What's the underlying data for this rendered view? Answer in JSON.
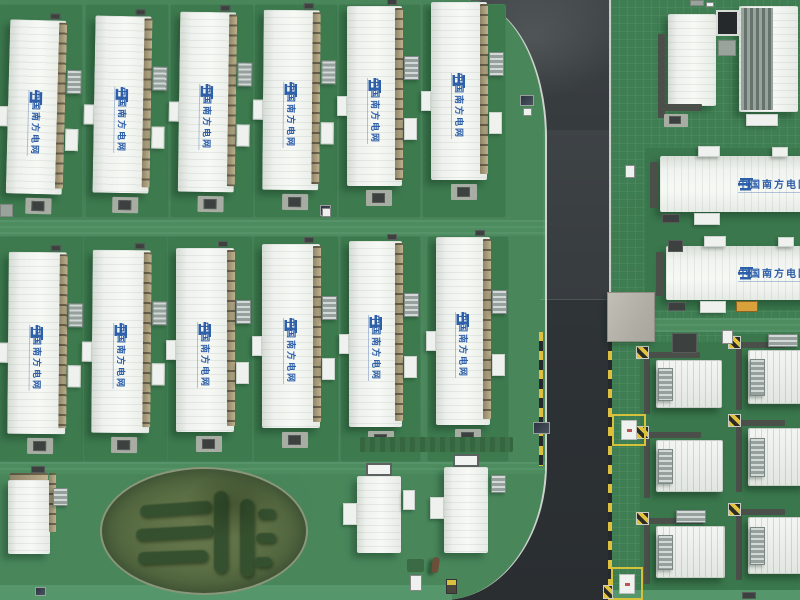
{
  "meta": {
    "title": "Aerial view of a China Southern Power Grid battery energy storage station",
    "view": "top-down drone photo",
    "width": 800,
    "height": 600
  },
  "branding": {
    "label": "中国南方电网",
    "logo": "csg-grid-logo",
    "brand_color": "#2e5fa9"
  },
  "palette": {
    "grass_base": "#49875b",
    "grass_pad": "#3d7a4e",
    "grass_right": "#3f7e52",
    "path_light": "#4c8c5f",
    "bottom_strip": "#55966b",
    "road_surface": "#303437",
    "curb_white": "#cdd2cc",
    "hazard_yellow": "#dec03e",
    "hazard_dark": "#26292c",
    "building_white": "#f3f5f2",
    "walkway_tan": "#b3a484",
    "oval_inner": "#5d7045",
    "hedge_dark": "#35502f",
    "concrete": "#b4b1a8"
  },
  "scene": {
    "road": {
      "x": 420,
      "w": 205,
      "curb_left_x": 545,
      "curb_right_x": 607,
      "dashes": [
        {
          "x": 539,
          "y": 332,
          "h": 134
        },
        {
          "x": 608,
          "y": 332,
          "h": 268
        }
      ]
    },
    "bands": [
      {
        "x": 0,
        "y": 220,
        "w": 545,
        "h": 16,
        "dir": "h"
      },
      {
        "x": 0,
        "y": 462,
        "w": 545,
        "h": 12,
        "dir": "h"
      },
      {
        "x": 609,
        "y": 318,
        "w": 191,
        "h": 14,
        "dir": "h"
      }
    ],
    "bottom_strips": [
      {
        "x": 0,
        "y": 585,
        "w": 452,
        "h": 15
      },
      {
        "x": 609,
        "y": 590,
        "w": 191,
        "h": 10
      }
    ],
    "pad_rows": [
      {
        "top": 4,
        "h": 214,
        "row": 1
      },
      {
        "top": 236,
        "h": 226,
        "row": 2
      }
    ],
    "pads_right": [
      {
        "x": 640,
        "y": 342,
        "w": 96,
        "h": 248
      },
      {
        "x": 736,
        "y": 334,
        "w": 64,
        "h": 256
      },
      {
        "x": 645,
        "y": 148,
        "w": 155,
        "h": 162
      }
    ],
    "vertical_buildings": [
      {
        "x": 8,
        "y": 20,
        "w": 56,
        "h": 174,
        "r": 1.5,
        "row": 1
      },
      {
        "x": 94,
        "y": 16,
        "w": 56,
        "h": 177,
        "r": 1.0,
        "row": 1
      },
      {
        "x": 179,
        "y": 12,
        "w": 56,
        "h": 180,
        "r": 0.8,
        "row": 1
      },
      {
        "x": 263,
        "y": 10,
        "w": 56,
        "h": 180,
        "r": 0.5,
        "row": 1
      },
      {
        "x": 347,
        "y": 6,
        "w": 55,
        "h": 180,
        "r": 0,
        "row": 1
      },
      {
        "x": 431,
        "y": 2,
        "w": 56,
        "h": 178,
        "r": 0,
        "row": 1
      },
      {
        "x": 8,
        "y": 252,
        "w": 58,
        "h": 182,
        "r": 0.5,
        "row": 2
      },
      {
        "x": 92,
        "y": 250,
        "w": 58,
        "h": 183,
        "r": 0.5,
        "row": 2
      },
      {
        "x": 176,
        "y": 248,
        "w": 58,
        "h": 184,
        "r": 0,
        "row": 2
      },
      {
        "x": 262,
        "y": 244,
        "w": 58,
        "h": 184,
        "r": 0,
        "row": 2
      },
      {
        "x": 349,
        "y": 241,
        "w": 53,
        "h": 186,
        "r": 0,
        "row": 2
      },
      {
        "x": 436,
        "y": 237,
        "w": 54,
        "h": 188,
        "r": 0,
        "row": 2
      }
    ],
    "horizontal_buildings": [
      {
        "x": 660,
        "y": 156,
        "w": 150,
        "h": 56,
        "brandLeft": 78,
        "orangeBox": false
      },
      {
        "x": 666,
        "y": 246,
        "w": 144,
        "h": 54,
        "brandLeft": 72,
        "orangeBox": true
      }
    ],
    "small_buildings": [
      {
        "x": 8,
        "y": 480,
        "w": 42,
        "h": 74,
        "vent": false,
        "acRight": true,
        "walkTop": true,
        "sideL": false,
        "sideR": false
      },
      {
        "x": 357,
        "y": 476,
        "w": 44,
        "h": 77,
        "vent": true,
        "acRight": false,
        "walkTop": false,
        "sideL": true,
        "sideR": true
      },
      {
        "x": 444,
        "y": 467,
        "w": 44,
        "h": 86,
        "vent": true,
        "acRight": true,
        "walkTop": false,
        "sideL": true,
        "sideR": false
      }
    ],
    "top_right": {
      "plain": {
        "x": 668,
        "y": 14,
        "w": 48,
        "h": 92
      },
      "ribbed": {
        "x": 739,
        "y": 6,
        "w": 59,
        "h": 106
      },
      "camera": {
        "x": 716,
        "y": 10,
        "w": 23,
        "h": 26
      },
      "camera_base": {
        "x": 718,
        "y": 40,
        "w": 18,
        "h": 16
      },
      "steps": {
        "x": 746,
        "y": 114,
        "w": 32,
        "h": 12
      }
    },
    "containers": [
      {
        "x": 656,
        "y": 360,
        "w": 66,
        "h": 48,
        "topUnit": false
      },
      {
        "x": 748,
        "y": 350,
        "w": 58,
        "h": 54,
        "topUnit": true
      },
      {
        "x": 656,
        "y": 440,
        "w": 67,
        "h": 52,
        "topUnit": false
      },
      {
        "x": 748,
        "y": 428,
        "w": 58,
        "h": 58,
        "topUnit": false
      },
      {
        "x": 656,
        "y": 526,
        "w": 69,
        "h": 52,
        "topUnit": true
      },
      {
        "x": 748,
        "y": 517,
        "w": 58,
        "h": 57,
        "topUnit": false
      }
    ],
    "yellow_boxes": [
      {
        "x": 612,
        "y": 414,
        "w": 34,
        "h": 32
      },
      {
        "x": 611,
        "y": 567,
        "w": 32,
        "h": 33
      }
    ],
    "concrete_pad": {
      "x": 607,
      "y": 292,
      "w": 48,
      "h": 50
    },
    "dark_box": {
      "x": 672,
      "y": 333,
      "w": 25,
      "h": 20
    },
    "white_lid": {
      "x": 722,
      "y": 330,
      "w": 11,
      "h": 14
    },
    "oval": {
      "x": 100,
      "y": 467,
      "w": 208,
      "h": 128,
      "hedges": [
        {
          "x": 38,
          "y": 34,
          "w": 72,
          "h": 12,
          "r": -4
        },
        {
          "x": 34,
          "y": 58,
          "w": 78,
          "h": 12,
          "r": -3
        },
        {
          "x": 36,
          "y": 82,
          "w": 70,
          "h": 12,
          "r": -2
        },
        {
          "x": 112,
          "y": 22,
          "w": 14,
          "h": 82,
          "r": 0
        },
        {
          "x": 138,
          "y": 30,
          "w": 14,
          "h": 78,
          "r": 0
        },
        {
          "x": 156,
          "y": 40,
          "w": 18,
          "h": 10,
          "r": 0
        },
        {
          "x": 154,
          "y": 64,
          "w": 20,
          "h": 10,
          "r": 0
        },
        {
          "x": 152,
          "y": 88,
          "w": 18,
          "h": 10,
          "r": 0
        }
      ]
    },
    "props": [
      {
        "type": "panel",
        "x": 520,
        "y": 95,
        "w": 14,
        "h": 11
      },
      {
        "type": "whitebox",
        "x": 523,
        "y": 108,
        "w": 9,
        "h": 8
      },
      {
        "type": "panel",
        "x": 533,
        "y": 422,
        "w": 17,
        "h": 12
      },
      {
        "type": "panel",
        "x": 320,
        "y": 205,
        "w": 11,
        "h": 11
      },
      {
        "type": "panel",
        "x": 35,
        "y": 587,
        "w": 11,
        "h": 9
      },
      {
        "type": "whitebox",
        "x": 625,
        "y": 165,
        "w": 10,
        "h": 13
      },
      {
        "type": "darkbox",
        "x": 668,
        "y": 240,
        "w": 15,
        "h": 12
      },
      {
        "type": "graypad",
        "x": 0,
        "y": 204,
        "w": 13,
        "h": 13
      },
      {
        "type": "person",
        "x": 432,
        "y": 557,
        "w": 7,
        "h": 16
      },
      {
        "type": "whitebox",
        "x": 410,
        "y": 575,
        "w": 12,
        "h": 16
      },
      {
        "type": "sign",
        "x": 446,
        "y": 579,
        "w": 11,
        "h": 15
      },
      {
        "type": "mat",
        "x": 360,
        "y": 437,
        "w": 153,
        "h": 15
      },
      {
        "type": "mat2",
        "x": 407,
        "y": 559,
        "w": 17,
        "h": 13
      },
      {
        "type": "darkbox",
        "x": 742,
        "y": 592,
        "w": 14,
        "h": 7
      },
      {
        "type": "graypad",
        "x": 690,
        "y": 0,
        "w": 14,
        "h": 6
      },
      {
        "type": "whitebox",
        "x": 706,
        "y": 2,
        "w": 8,
        "h": 5
      },
      {
        "type": "hazard",
        "x": 603,
        "y": 585,
        "w": 10,
        "h": 14
      },
      {
        "type": "whitebox",
        "x": 322,
        "y": 208,
        "w": 9,
        "h": 9
      }
    ]
  }
}
